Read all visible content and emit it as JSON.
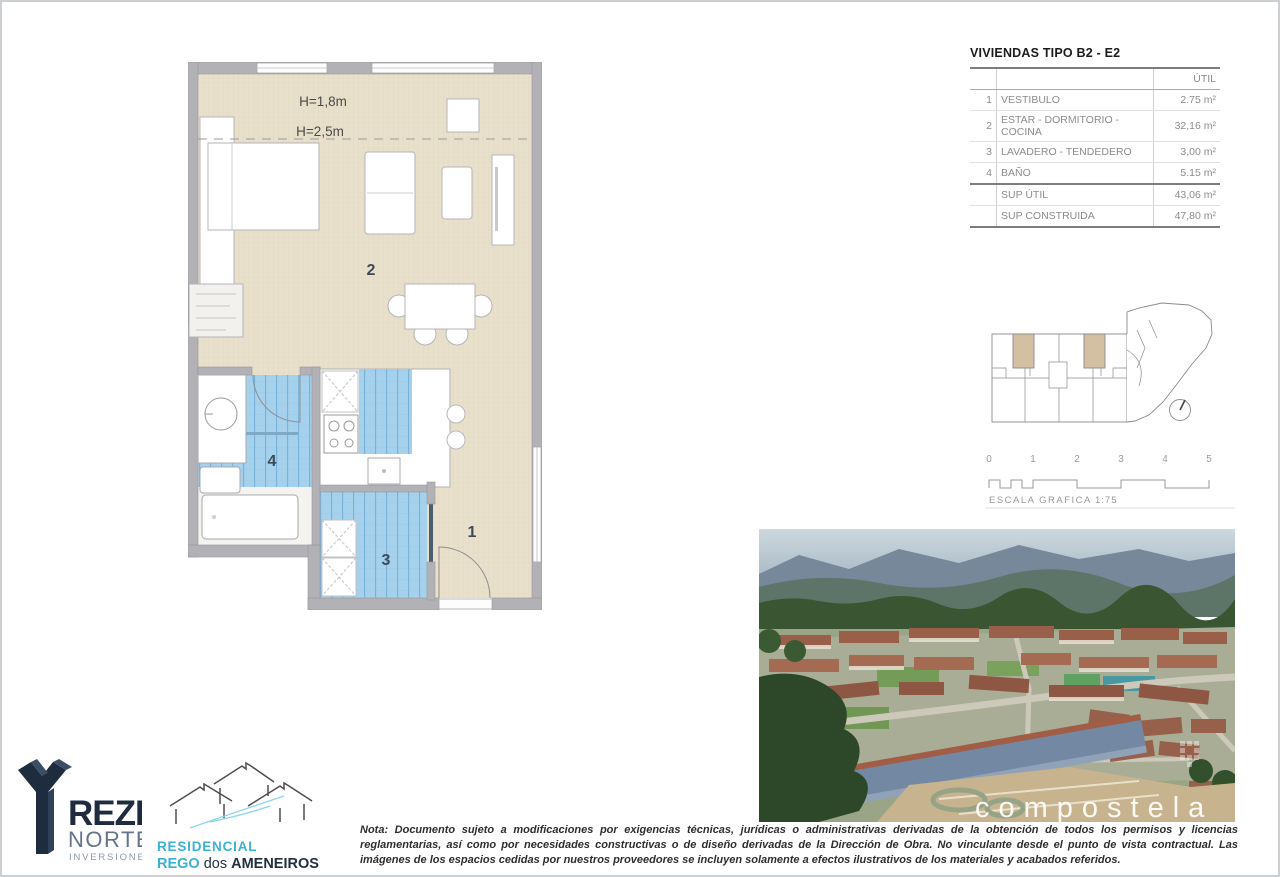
{
  "unit_table": {
    "title": "VIVIENDAS TIPO B2 - E2",
    "col_header": "ÚTIL",
    "rows": [
      {
        "num": "1",
        "label": "VESTIBULO",
        "value": "2.75 m²"
      },
      {
        "num": "2",
        "label": "ESTAR - DORMITORIO - COCINA",
        "value": "32,16 m²"
      },
      {
        "num": "3",
        "label": "LAVADERO - TENDEDERO",
        "value": "3,00 m²"
      },
      {
        "num": "4",
        "label": "BAÑO",
        "value": "5.15 m²"
      }
    ],
    "summary": [
      {
        "label": "SUP ÚTIL",
        "value": "43,06 m²"
      },
      {
        "label": "SUP CONSTRUIDA",
        "value": "47,80 m²"
      }
    ]
  },
  "floorplan": {
    "labels": {
      "h1": "H=1,8m",
      "h2": "H=2,5m",
      "room1": "1",
      "room2": "2",
      "room3": "3",
      "room4": "4"
    },
    "colors": {
      "wall": "#b2b2b6",
      "floor": "#e8e0cb",
      "tile": "#a5d1ec"
    }
  },
  "scalebar": {
    "ticks": [
      "0",
      "1",
      "2",
      "3",
      "4",
      "5"
    ],
    "caption": "ESCALA GRAFICA",
    "ratio": "1:75"
  },
  "photo": {
    "watermark": "compostela"
  },
  "logos": {
    "treze": {
      "wordmark": "REZE",
      "line2": "NORTE",
      "line3": "INVERSIONES",
      "navy": "#1f2c3f"
    },
    "residencial": {
      "line1": "RESIDENCIAL",
      "rego": "REGO",
      "dos": "dos",
      "ameneiros": "AMENEIROS",
      "cyan": "#3cb1d3"
    }
  },
  "note": {
    "text": "Nota: Documento sujeto a modificaciones por exigencias técnicas, jurídicas o administrativas derivadas de la obtención de todos los permisos y licencias reglamentarias, así como por necesidades constructivas o de diseño derivadas de la Dirección de Obra. No vinculante desde el punto de vista contractual. Las imágenes de los espacios cedidas por nuestros proveedores se incluyen solamente a efectos ilustrativos de los materiales y acabados referidos."
  }
}
